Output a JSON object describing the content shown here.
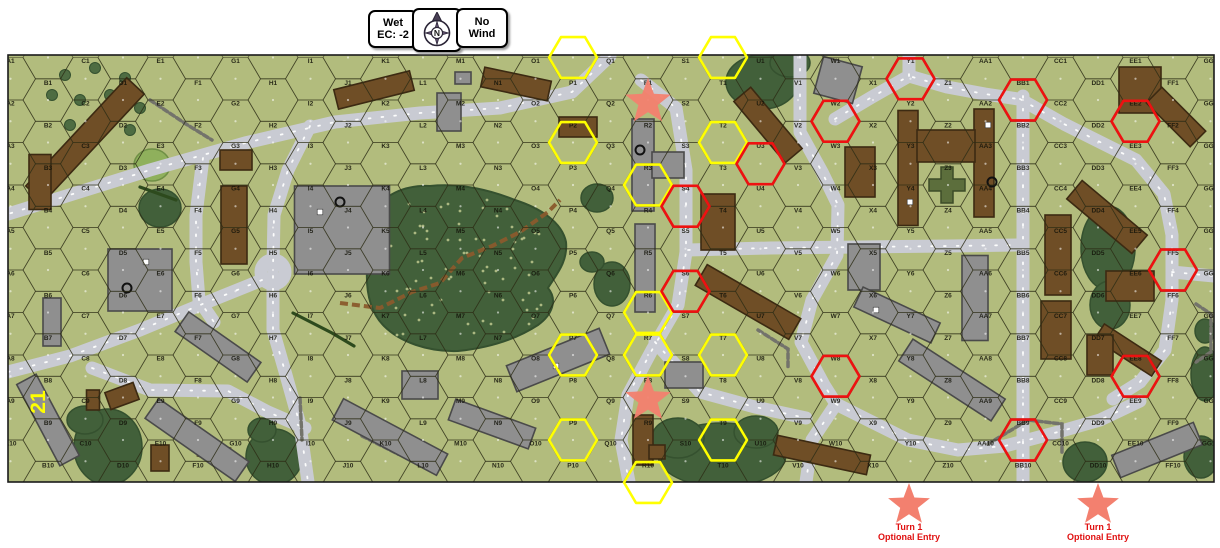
{
  "toolbar": {
    "weather_button": {
      "line1": "Wet",
      "line2": "EC: -2"
    },
    "compass_button": {
      "letter": "N"
    },
    "wind_button": {
      "line1": "No",
      "line2": "Wind"
    }
  },
  "board": {
    "number": "21",
    "columns": [
      "A",
      "B",
      "C",
      "D",
      "E",
      "F",
      "G",
      "H",
      "I",
      "J",
      "K",
      "L",
      "M",
      "N",
      "O",
      "P",
      "Q",
      "R",
      "S",
      "T",
      "U",
      "V",
      "W",
      "X",
      "Y",
      "Z",
      "AA",
      "BB",
      "CC",
      "DD",
      "EE",
      "FF",
      "GG"
    ],
    "row_count": 10
  },
  "overlays": {
    "yellow_hexes": [
      "P0",
      "T0",
      "P2",
      "T2",
      "R3",
      "R6",
      "R7",
      "P7",
      "T7",
      "P9",
      "T9",
      "R10"
    ],
    "red_hexes": [
      "Y1",
      "BB1",
      "W2",
      "EE2",
      "U3",
      "S4",
      "S6",
      "FF5",
      "W8",
      "EE8",
      "BB9"
    ],
    "star_hexes": [
      "R1",
      "R8"
    ]
  },
  "entry_markers": [
    {
      "line1": "Turn 1",
      "line2": "Optional Entry"
    },
    {
      "line1": "Turn 1",
      "line2": "Optional Entry"
    }
  ],
  "colors": {
    "board_green": "#b2bc7d",
    "woods_green": "#42603a",
    "light_woods_green": "#8fb05c",
    "road_gray": "#c9cbd3",
    "dirt_path_brown": "#8a5a2c",
    "highlight_yellow": "#ffff00",
    "highlight_red": "#ee1111",
    "star_salmon": "#f3806f",
    "entry_text_red": "#e01010",
    "building_brown": "#6f4e26",
    "building_gray": "#8f8f8f",
    "board_label_yellow": "#ffff00"
  }
}
